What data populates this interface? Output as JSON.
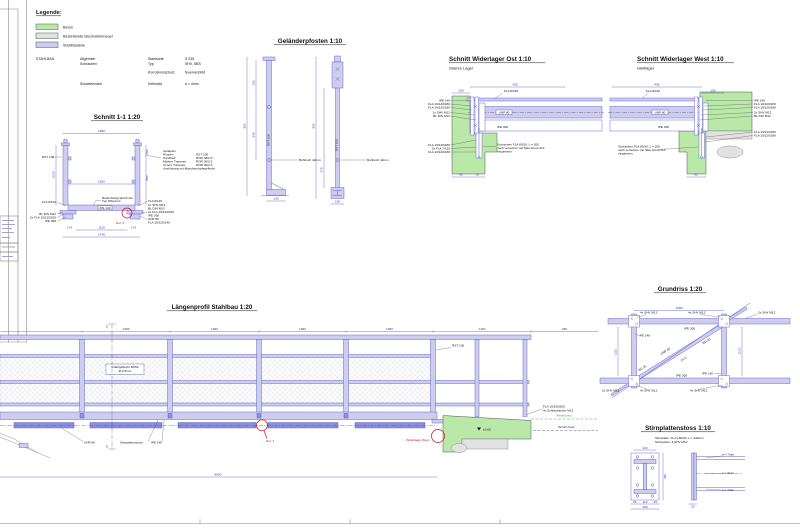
{
  "colors": {
    "beton": "#b9e8a9",
    "bruchstein": "#e2e2e2",
    "stahl": "#cdcdf0",
    "stahl_dark": "#8e90dd",
    "line_blue": "#5b5cc8",
    "dim_blue": "#3a3ab8",
    "red": "#cc1111",
    "terrain_green": "#2e9b2e"
  },
  "legend": {
    "title": "Legende:",
    "items": [
      {
        "label": "Beton"
      },
      {
        "label": "Bestehende Bruchsteinmauer"
      },
      {
        "label": "Stahlbauteile"
      }
    ]
  },
  "specs": {
    "group": "STAHLBAU",
    "rows": [
      {
        "c1": "Allgemein",
        "c2": "Stahlsorte",
        "c3": "S 235"
      },
      {
        "c1": "Schrauben",
        "c2": "Typ",
        "c3": "SHV, SBS"
      },
      {
        "c1": "",
        "c2": "Korrosionsschutz",
        "c3": "feuerverzinkt"
      },
      {
        "c1": "Schweissnaht",
        "c2": "Kehlnaht",
        "c3": "a = 4mm"
      }
    ]
  },
  "schnitt11": {
    "title": "Schnitt 1-1  1:20",
    "post_label": "RST 100",
    "deck_label": "IPE 140",
    "note": [
      "Bodenbelag Sprüh AG",
      "Typ Offenrost"
    ],
    "detail": "Det. 2",
    "rail_rows": [
      {
        "label": "Geländer",
        "value": ""
      },
      {
        "label": "Pfosten",
        "value": "RST 100"
      },
      {
        "label": "Handlauf",
        "value": "ROR 38/2.5"
      },
      {
        "label": "Mittlere Traverse",
        "value": "ROR 30/2.5"
      },
      {
        "label": "Untere Traverse",
        "value": "ROR 30/2.5"
      },
      {
        "label": "Ausführung mit Maschendrahtgeflecht",
        "value": ""
      }
    ],
    "left_labels": [
      "FLA 8/120",
      "BL DIN M12",
      "2x FLA 15/120/100",
      "IPE 300"
    ],
    "right_labels": [
      "FLA 8/120",
      "2x SHV M12",
      "BL DIN M12",
      "2x FLA 15/120/100",
      "IPE 300",
      "UNP 80",
      "FLA 10/120/140"
    ],
    "dims": {
      "top": "1950",
      "inner": "1500",
      "bottom_inner": "1110",
      "bottom_total": "1740",
      "side_left": "170",
      "side_right": "170",
      "height": "1025",
      "seg_top": "150",
      "seg_mid": "850"
    }
  },
  "pfosten": {
    "title": "Geländerpfosten  1:10",
    "hole_label": "Bohrloch 42mm",
    "post_text": "RST 100",
    "dims": {
      "height": "950",
      "seg_upper": "150",
      "seg_lower": "545",
      "base": "130",
      "right_seg": "275"
    }
  },
  "wl_ost": {
    "title": "Schnitt Widerlager Ost  1:10",
    "subtitle": "Starres Lager",
    "beam_top": "FLA 8/120",
    "beam_unp": "UNP 80",
    "beam_ipe": "IPE 300",
    "left_labels": [
      "IPE 140",
      "FLA 10/120/180",
      "FLA 10/120/180",
      "2x SHV M12",
      "BL DIN M12"
    ],
    "lower_labels": [
      "FLA 15/120/180",
      "2x FLA 7/120",
      "FLA 10/120/180"
    ],
    "dims": {
      "a": "455",
      "b": "150",
      "c": "95",
      "d": "30"
    }
  },
  "wl_west": {
    "title": "Schnitt Widerlager West  1:10",
    "subtitle": "Gleitlager",
    "beam_top": "FLA 8/120",
    "beam_unp": "UNP 80",
    "beam_ipe": "IPE 300",
    "right_labels": [
      "IPE 140",
      "FLA 10/120/180",
      "FLA 10/120/180",
      "2x SHV M12",
      "BL DIN M12"
    ],
    "lower_labels": [
      "FLA 15/120/180",
      "FLA 10/120/180"
    ],
    "dims": {
      "a": "455",
      "b": "150",
      "c": "95"
    }
  },
  "anker_note": [
    "Schrauben FLA 80/10, L = 200",
    "nach versetzen mit Sika Grout 314",
    "eingiessen"
  ],
  "profil": {
    "title": "Längenprofil Stahlbau  1:20",
    "mesh_note": [
      "Drahtgeflecht 50/50",
      "Ø 2.5mm"
    ],
    "labels": {
      "unp": "UNP 80",
      "stoss": "Stirnplattenstoss",
      "ipe140": "IPE 140",
      "rst": "RST 100",
      "det1": "Det. 1",
      "widerlager_west": "Widerlager West",
      "terrain_neu": "Terrain neu",
      "terrain_best": "Terrain best.",
      "fla": "FLA 10/150/200",
      "anker": "4x Schraubanker M12",
      "level": "±0.00",
      "section_marker": "1"
    },
    "dims": {
      "bay": "1980",
      "bay_right": "1460",
      "end": "280",
      "total": "8900"
    }
  },
  "grundriss": {
    "title": "Grundriss  1:20",
    "labels": {
      "shv4": "4x SHV M12",
      "shv2": "2x SHV M12",
      "ipe300": "IPE 300",
      "ipe140": "IPE 140",
      "unp": "UNP 80",
      "rd": "RD 20"
    },
    "dims": {
      "top": "1980",
      "left": "1110",
      "right": "1170",
      "diag": "2670"
    }
  },
  "stoss": {
    "title": "Stirnplattenstoss  1:10",
    "notes": [
      "Stirnplatte:   FLA 180/20, L = 440mm",
      "Schrauben:   8 SHV M12"
    ],
    "welds": [
      "a = 7mm",
      "a = 4mm",
      "a = 7mm"
    ],
    "dims": {
      "edge": "35",
      "mid": "110",
      "width": "180",
      "height": "440",
      "plate": "20"
    }
  }
}
